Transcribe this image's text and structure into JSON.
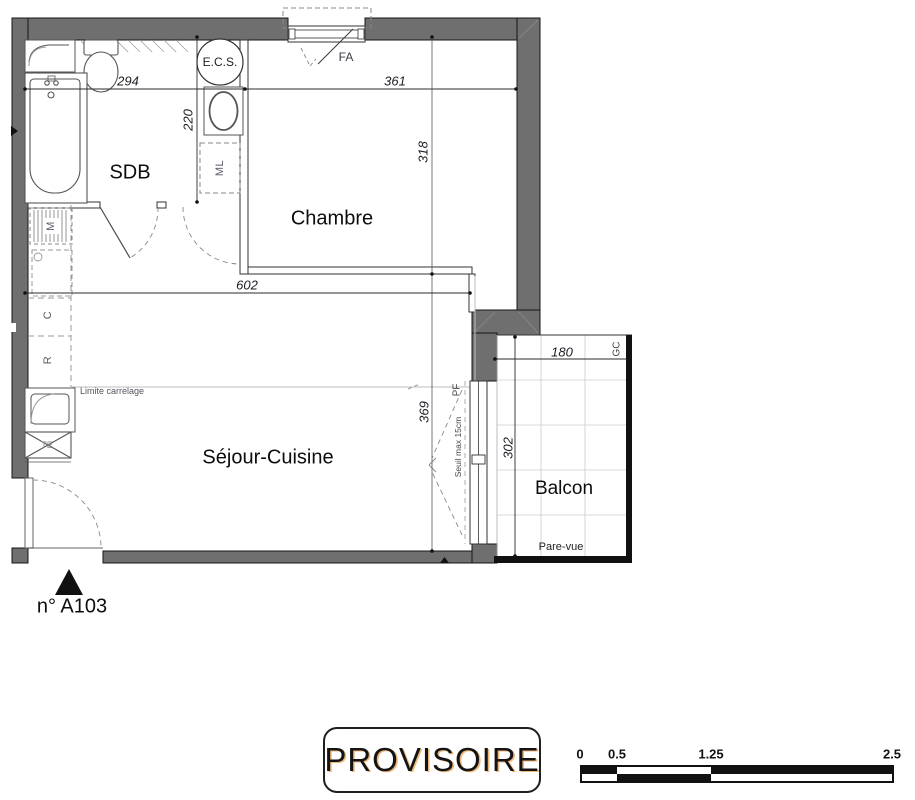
{
  "texts": {
    "room_sdb": "SDB",
    "room_chambre": "Chambre",
    "room_sejour": "Séjour-Cuisine",
    "room_balcon": "Balcon",
    "ecs": "E.C.S.",
    "fa": "FA",
    "ml": "ML",
    "c": "C",
    "r": "R",
    "m": "M",
    "te": "TE",
    "gc": "GC",
    "pf": "PF",
    "seuil": "Seuil max 15cm",
    "limite_carrelage": "Limite carrelage",
    "pare_vue": "Pare-vue",
    "unit": "n° A103",
    "stamp": "PROVISOIRE"
  },
  "dimensions_cm": {
    "sdb_width": "294",
    "sdb_height": "220",
    "chambre_width": "361",
    "chambre_height": "318",
    "sejour_width": "602",
    "sejour_height": "369",
    "balcon_width": "180",
    "balcon_height": "302"
  },
  "scale_bar": {
    "ticks": [
      "0",
      "0.5",
      "1.25",
      "2.5"
    ]
  },
  "colors": {
    "wall_fill": "#6f6f6f",
    "outline": "#1a1a1a",
    "rail": "#111111",
    "stamp_shadow": "#e2861c"
  }
}
